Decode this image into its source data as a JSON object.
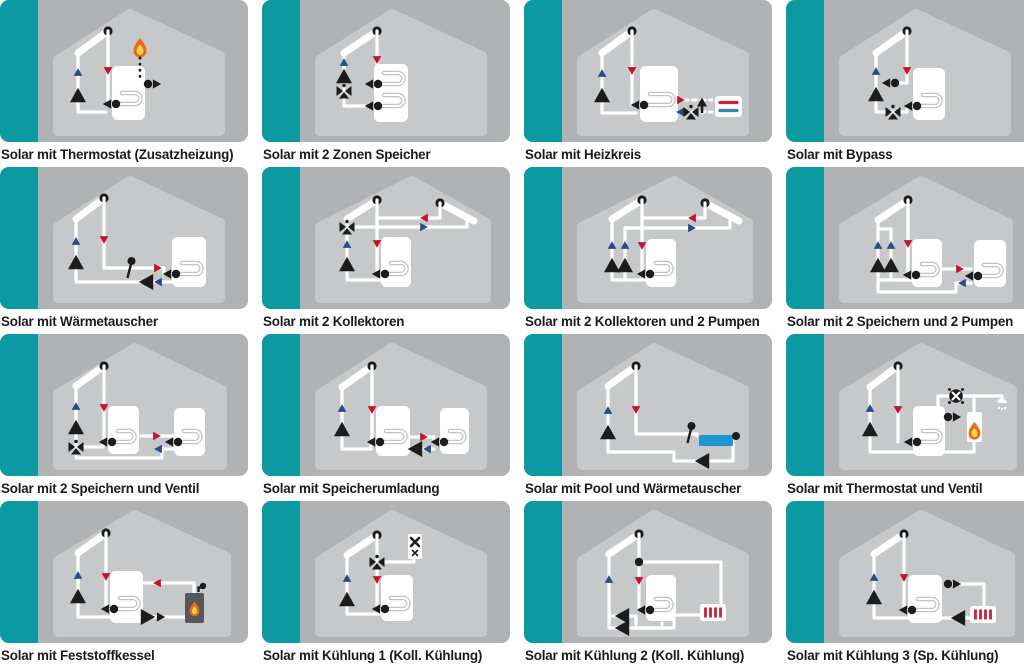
{
  "title": "Solar-Schemata Übersicht",
  "colors": {
    "page_bg": "#ffffff",
    "teal": "#0b9aa2",
    "tile_bg": "#b1b2b4",
    "house": "#c7c8ca",
    "coil": "#c2c3c5",
    "pipe": "#ffffff",
    "black": "#1c1c1c",
    "arrow_red": "#c41230",
    "arrow_blue": "#2b4a8b",
    "heizkreis_blue": "#3d7fa6",
    "radiator_red": "#cf1f3c",
    "pool_blue": "#2095d2",
    "flame_orange": "#e96c18",
    "flame_yellow": "#ffd34f",
    "boiler_gray": "#55575a",
    "caption_text": "#1b1b1b"
  },
  "tiles": [
    {
      "id": "solar-thermostat-zusatzheizung",
      "caption": "Solar mit Thermostat (Zusatzheizung)",
      "components": [
        "solar-collector",
        "pump",
        "flow-arrows",
        "storage-tank",
        "coil",
        "flame-icon",
        "thermostat-dotted-line",
        "connection-dot-arrow"
      ]
    },
    {
      "id": "solar-2-zonen-speicher",
      "caption": "Solar mit 2 Zonen Speicher",
      "components": [
        "solar-collector",
        "pump",
        "three-way-valve",
        "flow-arrows",
        "storage-tank",
        "two-coils"
      ]
    },
    {
      "id": "solar-heizkreis",
      "caption": "Solar mit Heizkreis",
      "components": [
        "solar-collector",
        "pump",
        "flow-arrows",
        "storage-tank",
        "coil",
        "heizkreis-valve",
        "heizkreis-pump",
        "heizkreis-radiator"
      ]
    },
    {
      "id": "solar-bypass",
      "caption": "Solar mit Bypass",
      "components": [
        "solar-collector",
        "pump",
        "bypass-arrow",
        "three-way-valve",
        "flow-arrows",
        "storage-tank",
        "coil"
      ]
    },
    {
      "id": "solar-waermetauscher",
      "caption": "Solar mit Wärmetauscher",
      "components": [
        "solar-collector",
        "pump",
        "flow-arrows",
        "heat-exchanger-sensor",
        "secondary-pump",
        "storage-tank",
        "coil"
      ]
    },
    {
      "id": "solar-2-kollektoren",
      "caption": "Solar mit 2 Kollektoren",
      "components": [
        "solar-collector-left",
        "solar-collector-right",
        "pump",
        "three-way-valve",
        "flow-arrows",
        "storage-tank",
        "coil"
      ]
    },
    {
      "id": "solar-2-kollektoren-2-pumpen",
      "caption": "Solar mit 2 Kollektoren und 2 Pumpen",
      "components": [
        "solar-collector-left",
        "solar-collector-right",
        "pump-1",
        "pump-2",
        "flow-arrows",
        "storage-tank",
        "coil"
      ]
    },
    {
      "id": "solar-2-speichern-2-pumpen",
      "caption": "Solar mit 2 Speichern und 2 Pumpen",
      "components": [
        "solar-collector",
        "pump-1",
        "pump-2",
        "flow-arrows",
        "storage-tank-1",
        "storage-tank-2",
        "coils"
      ]
    },
    {
      "id": "solar-2-speichern-ventil",
      "caption": "Solar mit 2 Speichern und Ventil",
      "components": [
        "solar-collector",
        "pump",
        "three-way-valve",
        "flow-arrows",
        "storage-tank-1",
        "storage-tank-2",
        "coils"
      ]
    },
    {
      "id": "solar-speicherumladung",
      "caption": "Solar mit Speicherumladung",
      "components": [
        "solar-collector",
        "pump",
        "transfer-pump",
        "flow-arrows",
        "storage-tank-1",
        "storage-tank-2",
        "coils"
      ]
    },
    {
      "id": "solar-pool-waermetauscher",
      "caption": "Solar mit Pool und Wärmetauscher",
      "components": [
        "solar-collector",
        "pump",
        "flow-arrows",
        "heat-exchanger-sensor",
        "pool",
        "pool-pump"
      ]
    },
    {
      "id": "solar-thermostat-ventil",
      "caption": "Solar mit Thermostat und Ventil",
      "components": [
        "solar-collector",
        "pump",
        "flow-arrows",
        "storage-tank",
        "coil",
        "mixing-valve",
        "boiler-flame",
        "shower-icon",
        "connection-dot-arrow"
      ]
    },
    {
      "id": "solar-feststoffkessel",
      "caption": "Solar mit Feststoffkessel",
      "components": [
        "solar-collector",
        "pump",
        "flow-arrows",
        "storage-tank",
        "coil",
        "solid-fuel-boiler",
        "boiler-pump"
      ]
    },
    {
      "id": "solar-kuehlung-1",
      "caption": "Solar mit Kühlung 1 (Koll. Kühlung)",
      "components": [
        "solar-collector",
        "pump",
        "three-way-valve",
        "flow-arrows",
        "storage-tank",
        "coil",
        "cooler-box"
      ]
    },
    {
      "id": "solar-kuehlung-2",
      "caption": "Solar mit Kühlung 2 (Koll. Kühlung)",
      "components": [
        "solar-collector",
        "pump-1",
        "pump-2",
        "flow-arrows",
        "storage-tank",
        "coil",
        "cooling-radiator"
      ]
    },
    {
      "id": "solar-kuehlung-3",
      "caption": "Solar mit Kühlung 3 (Sp. Kühlung)",
      "components": [
        "solar-collector",
        "pump",
        "flow-arrows",
        "storage-tank",
        "coil",
        "cooling-radiator",
        "radiator-pump",
        "connection-dot-arrow"
      ]
    }
  ]
}
